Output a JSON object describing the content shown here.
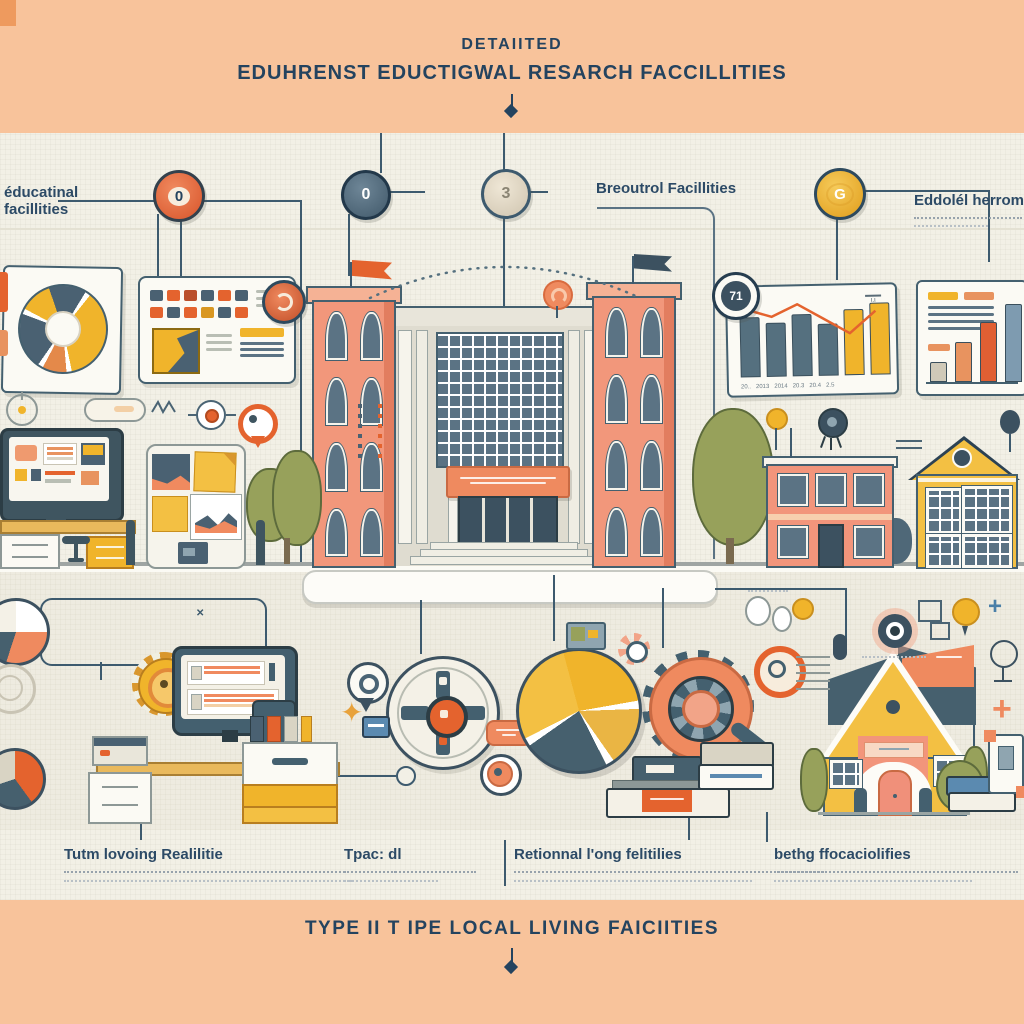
{
  "top_banner": {
    "line1": "DETAIITED",
    "line2": "EDUHRENST EDUCTIGWAL RESARCH FACCILLITIES"
  },
  "bottom_banner": {
    "title": "TYPE II T IPE LOCAL LIVING FAICIITIES"
  },
  "upper_diagram": {
    "left_label": {
      "line1": "éducatinal",
      "line2": "facillities"
    },
    "mid_label": "Breoutrol Facillities",
    "right_label": {
      "heading": "Eddolél herrom"
    },
    "badges": {
      "badge_orange": "0",
      "badge_navy": "0",
      "badge_beige": "3",
      "badge_yellow": "G",
      "badge_chart": "71"
    }
  },
  "lower_diagram": {
    "labels": [
      {
        "heading": "Tutm lovoing Realilitie"
      },
      {
        "heading": "Tpac: dl"
      },
      {
        "heading": "Retionnal l'ong felitilies"
      },
      {
        "heading": "bethg ffocaciolifies"
      }
    ]
  },
  "chart_data": [
    {
      "type": "bar",
      "title": "mini trend chart",
      "categories": [
        "20..",
        "2013",
        "2014",
        "20.3",
        "20.4",
        "2.5"
      ],
      "values": [
        58,
        52,
        60,
        50,
        64,
        70
      ],
      "bar_colors": [
        "slate",
        "slate",
        "slate",
        "slate",
        "yellow",
        "yellow"
      ],
      "line_points": [
        66,
        58,
        70,
        55,
        40,
        62
      ],
      "legend_position": "none",
      "note": "orange zigzag trend line over bars"
    },
    {
      "type": "bar",
      "title": "ascending bar chart",
      "categories": [
        "",
        "",
        "",
        ""
      ],
      "values": [
        18,
        38,
        58,
        76
      ],
      "bar_colors": [
        "#CFC9B8",
        "#E8935F",
        "#E05F33",
        "#7E9BB0"
      ]
    }
  ],
  "colors": {
    "peach": "#F8C39B",
    "cream": "#F2F0E6",
    "navy": "#24435F",
    "slate": "#4A6474",
    "orange": "#E4632E",
    "salmon": "#F2957B",
    "yellow": "#F0B42B",
    "olive": "#97A15B",
    "panel": "#FBFAF4",
    "lineC": "#3D5A6E"
  }
}
